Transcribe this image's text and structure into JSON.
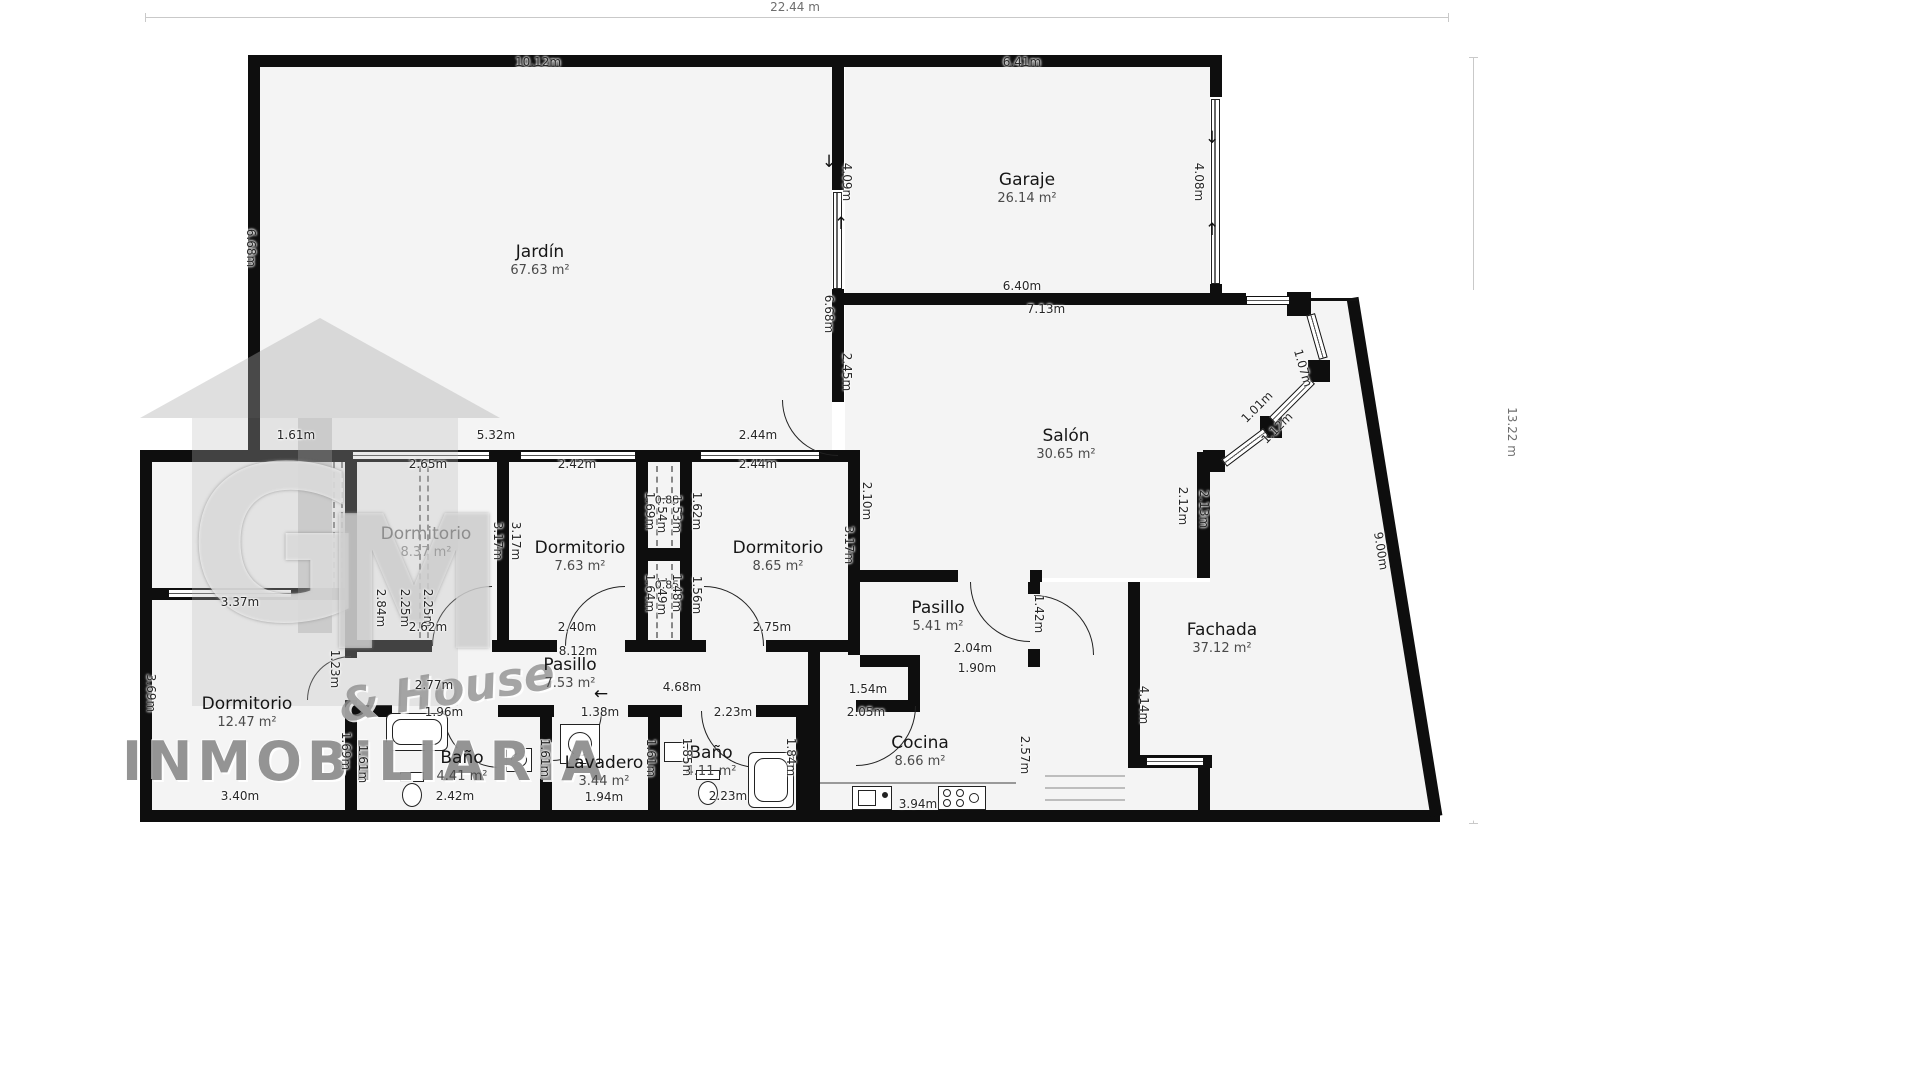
{
  "watermark": {
    "brand": "INMOBILIARIA",
    "tagline": "& House",
    "monogram_g": "G",
    "monogram_m": "M"
  },
  "overall": {
    "width_label": "22.44 m",
    "height_label": "13.22 m"
  },
  "rooms": [
    {
      "name": "Jardín",
      "area": "67.63 m²",
      "x": 540,
      "y": 242,
      "muted": false
    },
    {
      "name": "Garaje",
      "area": "26.14 m²",
      "x": 1027,
      "y": 170,
      "muted": false
    },
    {
      "name": "Salón",
      "area": "30.65 m²",
      "x": 1066,
      "y": 426,
      "muted": false
    },
    {
      "name": "Fachada",
      "area": "37.12 m²",
      "x": 1222,
      "y": 620,
      "muted": false
    },
    {
      "name": "Dormitorio",
      "area": "8.37 m²",
      "x": 426,
      "y": 524,
      "muted": true
    },
    {
      "name": "Dormitorio",
      "area": "7.63 m²",
      "x": 580,
      "y": 538,
      "muted": false
    },
    {
      "name": "Dormitorio",
      "area": "8.65 m²",
      "x": 778,
      "y": 538,
      "muted": false
    },
    {
      "name": "Pasillo",
      "area": "7.53 m²",
      "x": 570,
      "y": 655,
      "muted": false
    },
    {
      "name": "Pasillo",
      "area": "5.41 m²",
      "x": 938,
      "y": 598,
      "muted": false
    },
    {
      "name": "Dormitorio",
      "area": "12.47 m²",
      "x": 247,
      "y": 694,
      "muted": false
    },
    {
      "name": "Baño",
      "area": "4.41 m²",
      "x": 462,
      "y": 748,
      "muted": false
    },
    {
      "name": "Lavadero",
      "area": "3.44 m²",
      "x": 604,
      "y": 753,
      "muted": false
    },
    {
      "name": "Baño",
      "area": "4.11 m²",
      "x": 711,
      "y": 743,
      "muted": false
    },
    {
      "name": "Cocina",
      "area": "8.66 m²",
      "x": 920,
      "y": 733,
      "muted": false
    }
  ],
  "dims": [
    {
      "t": "22.44 m",
      "x": 795,
      "y": 7,
      "r": "h",
      "big": true
    },
    {
      "t": "13.22 m",
      "x": 1512,
      "y": 432,
      "r": "v",
      "big": true
    },
    {
      "t": "10.12m",
      "x": 538,
      "y": 62,
      "r": "h"
    },
    {
      "t": "6.68m",
      "x": 251,
      "y": 248,
      "r": "v"
    },
    {
      "t": "6.41m",
      "x": 1022,
      "y": 62,
      "r": "h"
    },
    {
      "t": "4.09m",
      "x": 847,
      "y": 182,
      "r": "v"
    },
    {
      "t": "6.68m",
      "x": 829,
      "y": 314,
      "r": "v"
    },
    {
      "t": "4.08m",
      "x": 1199,
      "y": 182,
      "r": "v"
    },
    {
      "t": "6.40m",
      "x": 1022,
      "y": 286,
      "r": "h"
    },
    {
      "t": "7.13m",
      "x": 1046,
      "y": 309,
      "r": "h"
    },
    {
      "t": "1.07m",
      "x": 1303,
      "y": 368,
      "r": 74
    },
    {
      "t": "1.01m",
      "x": 1257,
      "y": 407,
      "r": -45
    },
    {
      "t": "1.12m",
      "x": 1277,
      "y": 428,
      "r": -45
    },
    {
      "t": "2.12m",
      "x": 1183,
      "y": 506,
      "r": "v"
    },
    {
      "t": "2.13m",
      "x": 1204,
      "y": 509,
      "r": "v"
    },
    {
      "t": "9.00m",
      "x": 1381,
      "y": 551,
      "r": 81
    },
    {
      "t": "1.61m",
      "x": 296,
      "y": 435,
      "r": "h"
    },
    {
      "t": "5.32m",
      "x": 496,
      "y": 435,
      "r": "h"
    },
    {
      "t": "2.65m",
      "x": 428,
      "y": 464,
      "r": "h"
    },
    {
      "t": "2.42m",
      "x": 577,
      "y": 464,
      "r": "h"
    },
    {
      "t": "2.44m",
      "x": 758,
      "y": 435,
      "r": "h"
    },
    {
      "t": "2.44m",
      "x": 758,
      "y": 464,
      "r": "h"
    },
    {
      "t": "2.45m",
      "x": 847,
      "y": 372,
      "r": "v"
    },
    {
      "t": "2.10m",
      "x": 867,
      "y": 501,
      "r": "v"
    },
    {
      "t": "3.17m",
      "x": 849,
      "y": 545,
      "r": "v"
    },
    {
      "t": "3.17m",
      "x": 498,
      "y": 541,
      "r": "v"
    },
    {
      "t": "3.17m",
      "x": 516,
      "y": 541,
      "r": "v"
    },
    {
      "t": "2.84m",
      "x": 381,
      "y": 608,
      "r": "v"
    },
    {
      "t": "2.25m",
      "x": 405,
      "y": 608,
      "r": "v"
    },
    {
      "t": "2.25m",
      "x": 428,
      "y": 608,
      "r": "v"
    },
    {
      "t": "1.69m",
      "x": 650,
      "y": 511,
      "r": "v"
    },
    {
      "t": "1.54m",
      "x": 662,
      "y": 514,
      "r": "v"
    },
    {
      "t": "0.88",
      "x": 667,
      "y": 500,
      "r": "h",
      "small": true
    },
    {
      "t": "1.53m",
      "x": 677,
      "y": 514,
      "r": "v"
    },
    {
      "t": "1.62m",
      "x": 697,
      "y": 511,
      "r": "v"
    },
    {
      "t": "1.64m",
      "x": 650,
      "y": 593,
      "r": "v"
    },
    {
      "t": "1.49m",
      "x": 662,
      "y": 596,
      "r": "v"
    },
    {
      "t": "0.85",
      "x": 667,
      "y": 585,
      "r": "h",
      "small": true
    },
    {
      "t": "1.48m",
      "x": 677,
      "y": 593,
      "r": "v"
    },
    {
      "t": "1.56m",
      "x": 697,
      "y": 595,
      "r": "v"
    },
    {
      "t": "2.62m",
      "x": 428,
      "y": 627,
      "r": "h"
    },
    {
      "t": "2.40m",
      "x": 577,
      "y": 627,
      "r": "h"
    },
    {
      "t": "2.75m",
      "x": 772,
      "y": 627,
      "r": "h"
    },
    {
      "t": "8.12m",
      "x": 578,
      "y": 651,
      "r": "h"
    },
    {
      "t": "2.77m",
      "x": 434,
      "y": 685,
      "r": "h"
    },
    {
      "t": "4.68m",
      "x": 682,
      "y": 687,
      "r": "h"
    },
    {
      "t": "1.23m",
      "x": 335,
      "y": 669,
      "r": "v"
    },
    {
      "t": "3.37m",
      "x": 240,
      "y": 602,
      "r": "h"
    },
    {
      "t": "3.69m",
      "x": 151,
      "y": 693,
      "r": "v"
    },
    {
      "t": "3.40m",
      "x": 240,
      "y": 796,
      "r": "h"
    },
    {
      "t": "1.69m",
      "x": 346,
      "y": 751,
      "r": "v"
    },
    {
      "t": "1.61m",
      "x": 363,
      "y": 764,
      "r": "v"
    },
    {
      "t": "1.96m",
      "x": 444,
      "y": 712,
      "r": "h"
    },
    {
      "t": "2.42m",
      "x": 455,
      "y": 796,
      "r": "h"
    },
    {
      "t": "1.61m",
      "x": 545,
      "y": 758,
      "r": "v"
    },
    {
      "t": "1.38m",
      "x": 600,
      "y": 712,
      "r": "h"
    },
    {
      "t": "1.61m",
      "x": 651,
      "y": 758,
      "r": "v"
    },
    {
      "t": "1.94m",
      "x": 604,
      "y": 797,
      "r": "h"
    },
    {
      "t": "2.23m",
      "x": 733,
      "y": 712,
      "r": "h"
    },
    {
      "t": "1.85m",
      "x": 687,
      "y": 757,
      "r": "v"
    },
    {
      "t": "1.84m",
      "x": 791,
      "y": 757,
      "r": "v"
    },
    {
      "t": "2.23m",
      "x": 728,
      "y": 796,
      "r": "h"
    },
    {
      "t": "1.54m",
      "x": 868,
      "y": 689,
      "r": "h"
    },
    {
      "t": "2.05m",
      "x": 866,
      "y": 712,
      "r": "h"
    },
    {
      "t": "2.04m",
      "x": 973,
      "y": 648,
      "r": "h"
    },
    {
      "t": "1.90m",
      "x": 977,
      "y": 668,
      "r": "h"
    },
    {
      "t": "3.94m",
      "x": 918,
      "y": 804,
      "r": "h"
    },
    {
      "t": "2.57m",
      "x": 1025,
      "y": 755,
      "r": "v"
    },
    {
      "t": "4.14m",
      "x": 1144,
      "y": 705,
      "r": "v"
    },
    {
      "t": "1.42m",
      "x": 1039,
      "y": 614,
      "r": "v"
    }
  ],
  "arrows": [
    {
      "g": "↓",
      "x": 829,
      "y": 162
    },
    {
      "g": "↑",
      "x": 841,
      "y": 224
    },
    {
      "g": "↓",
      "x": 1212,
      "y": 138
    },
    {
      "g": "↑",
      "x": 1212,
      "y": 230
    },
    {
      "g": "←",
      "x": 601,
      "y": 694
    }
  ]
}
